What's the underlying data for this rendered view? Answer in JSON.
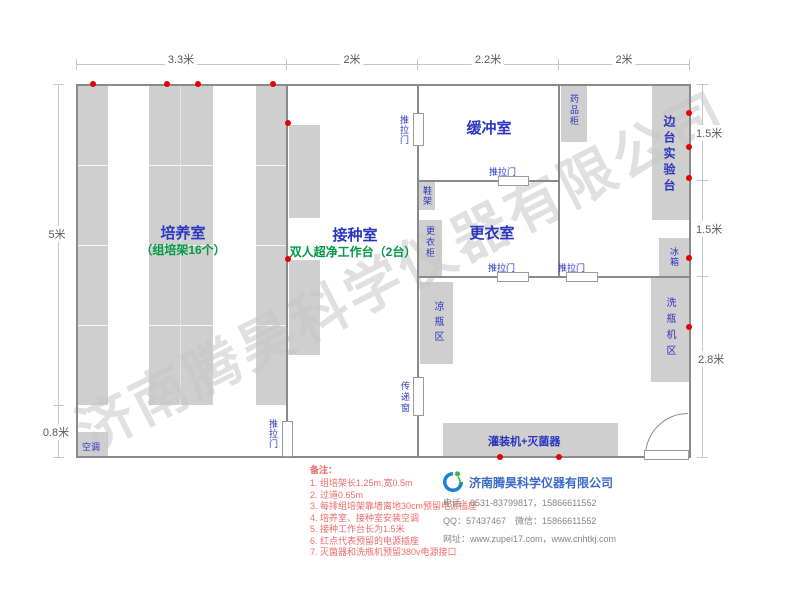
{
  "plan": {
    "dimensions": {
      "top": [
        "3.3米",
        "2米",
        "2.2米",
        "2米"
      ],
      "left": [
        "5米",
        "0.8米"
      ],
      "right": [
        "1.5米",
        "1.5米",
        "2.8米"
      ]
    },
    "rooms": {
      "culture": {
        "name": "培养室",
        "subtitle": "（组培架16个）"
      },
      "inoculation": {
        "name": "接种室",
        "subtitle": "双人超净工作台（2台）"
      },
      "buffer": {
        "name": "缓冲室"
      },
      "changing": {
        "name": "更衣室"
      },
      "side_bench": {
        "name": "边台实验台"
      }
    },
    "fixtures": {
      "ac": "空调",
      "shoe_rack": "鞋架",
      "wardrobe": "更衣柜",
      "medicine_cabinet": "药品柜",
      "fridge": "冰箱",
      "bottle_washer": "洗瓶机区",
      "bottle_cooling": "凉瓶区",
      "pass_window": "传递窗",
      "filling_sterilizer": "灌装机+灭菌器"
    },
    "door_label": "推拉门"
  },
  "notes": {
    "title": "备注：",
    "items": [
      "1. 组培架长1.25m,宽0.5m",
      "2. 过道0.65m",
      "3. 每排组培架靠墙离地30cm预留电源插座",
      "4. 培养室、接种室安装空调",
      "5. 接种工作台长为1.5米",
      "6. 红点代表预留的电源插座",
      "7. 灭菌器和洗瓶机预留380v电源接口"
    ]
  },
  "company": {
    "name": "济南腾昊科学仪器有限公司",
    "phone": "电话：0531-83799817，15866611552",
    "qq_wechat": "QQ：57437467　微信：15866611552",
    "website": "网址：www.zupei17.com，www.cnhtkj.com",
    "watermark": "济南腾昊科学仪器有限公司"
  },
  "colors": {
    "room_label_blue": "#2a35c0",
    "green_label": "#009948",
    "note_red": "#f06a6a",
    "outlet_red": "#e60000",
    "furniture_gray": "#cfcfcf",
    "wall_gray": "#8a8a8a",
    "company_blue": "#3a6bc8"
  }
}
